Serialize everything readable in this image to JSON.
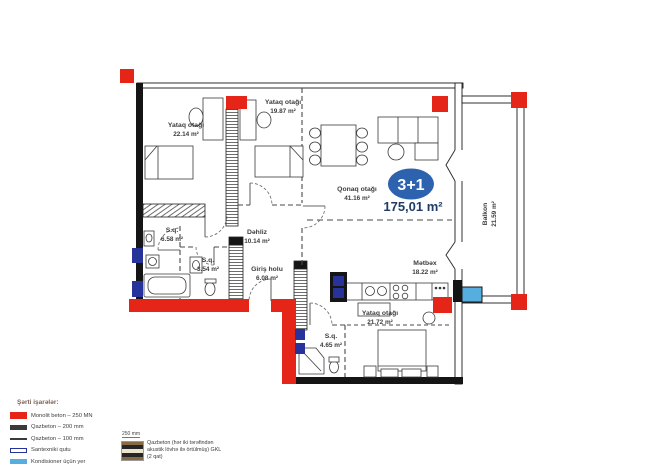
{
  "plan": {
    "badge": {
      "type_label": "3+1",
      "total_area": "175,01 m²"
    },
    "rooms": [
      {
        "name": "Yataq otağı",
        "area": "22.14 m²"
      },
      {
        "name": "Yataq otağı",
        "area": "19.87 m²"
      },
      {
        "name": "Qonaq otağı",
        "area": "41.16 m²"
      },
      {
        "name": "Dəhliz",
        "area": "10.14 m²"
      },
      {
        "name": "S.q.",
        "area": "6.58 m²"
      },
      {
        "name": "S.q.",
        "area": "3.54 m²"
      },
      {
        "name": "Giriş holu",
        "area": "6.08 m²"
      },
      {
        "name": "Mətbəx",
        "area": "18.22 m²"
      },
      {
        "name": "Yataq otağı",
        "area": "21.72 m²"
      },
      {
        "name": "S.q.",
        "area": "4.65 m²"
      },
      {
        "name": "Balkon",
        "area": "21.59 m²"
      }
    ]
  },
  "legend": {
    "title": "Şərti işarələr:",
    "items": [
      {
        "label": "Monolit beton – 250 MN",
        "style": "solid-red",
        "color": "#e62519"
      },
      {
        "label": "Qazbeton – 200 mm",
        "style": "solid-dark",
        "color": "#3a3a3a"
      },
      {
        "label": "Qazbeton – 100 mm",
        "style": "thin-line",
        "color": "#3a3a3a"
      },
      {
        "label": "Santexniki qutu",
        "style": "navy-outline",
        "color": "#28329b"
      },
      {
        "label": "Kondisioner üçün yer",
        "style": "solid-blue",
        "color": "#55aedd"
      }
    ]
  },
  "note": {
    "measure": "250 mm",
    "text": "Qazbeton (hər iki tərəfindən akustik lövhə ilə örtülmüş) GKL (2 qat)"
  },
  "colors": {
    "monolit_red": "#e62519",
    "santexnik_navy": "#28329b",
    "kondisioner_blue": "#55aedd",
    "badge_blue": "#2d63ae",
    "total_area_text": "#1e3c64"
  }
}
